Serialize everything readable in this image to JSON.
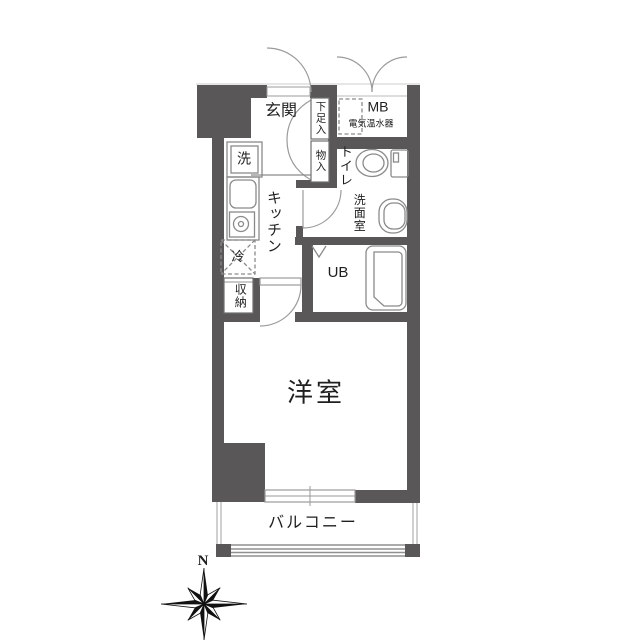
{
  "floor_plan": {
    "rooms": {
      "entrance": "玄関",
      "kitchen": "キッチン",
      "toilet": "トイレ",
      "washroom": "洗面室",
      "unit_bath": "UB",
      "western_room": "洋室",
      "balcony": "バルコニー"
    },
    "fixtures": {
      "shoe_box": "下足入",
      "closet": "物入",
      "meter_box": "MB",
      "water_heater": "電気温水器",
      "washer": "洗",
      "fridge": "冷",
      "storage": "収納"
    },
    "compass": {
      "north": "N"
    },
    "colors": {
      "wall": "#595757",
      "fixture_line": "#8a8a8a",
      "door_line": "#9b9b9b",
      "balcony_line": "#b0b0b0",
      "text": "#1f1f1f"
    }
  }
}
